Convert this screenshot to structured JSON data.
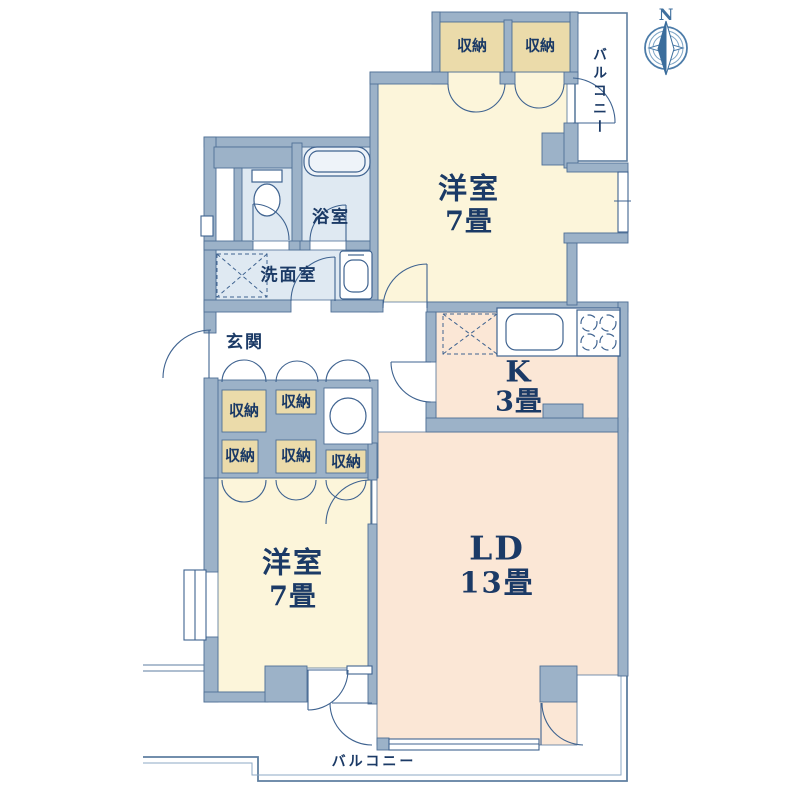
{
  "colors": {
    "wall_fill": "#9cb2c8",
    "wall_outline": "#4f7096",
    "bedroom_floor": "#fcf5da",
    "closet_fill": "#ebdbaa",
    "living_floor": "#fbe7d6",
    "wet_room_floor": "#dfe9f2",
    "label_text": "#1b3a66",
    "thin_line": "#5f7fa0",
    "compass_blue": "#3a6d9c"
  },
  "compass": {
    "north": "N"
  },
  "rooms": {
    "bedroom_top": {
      "name": "洋室",
      "size": "7畳"
    },
    "bedroom_left": {
      "name": "洋室",
      "size": "7畳"
    },
    "living_dining": {
      "name": "LD",
      "size": "13畳"
    },
    "kitchen": {
      "name": "K",
      "size": "3畳"
    },
    "entrance": {
      "name": "玄関"
    },
    "washroom": {
      "name": "洗面室"
    },
    "bathroom": {
      "name": "浴室"
    }
  },
  "closet_label": "収納",
  "balcony_label": "バルコニー"
}
